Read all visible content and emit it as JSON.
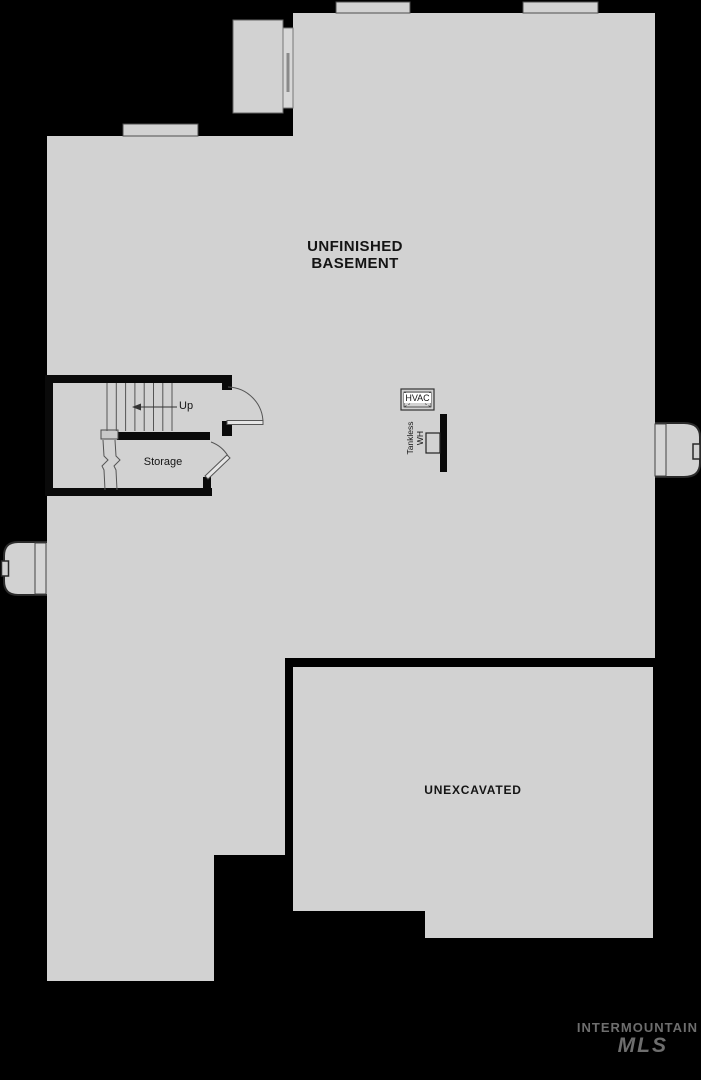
{
  "plan": {
    "rooms": {
      "main": {
        "label_line1": "UNFINISHED",
        "label_line2": "BASEMENT"
      },
      "unexcavated": {
        "label": "UNEXCAVATED"
      },
      "storage": {
        "label": "Storage"
      }
    },
    "stairs": {
      "direction_label": "Up"
    },
    "equipment": {
      "hvac_label": "HVAC",
      "water_heater_line1": "Tankless",
      "water_heater_line2": "WH"
    }
  },
  "watermark": {
    "line1": "INTERMOUNTAIN",
    "line2": "MLS"
  },
  "colors": {
    "background": "#000000",
    "floor": "#d2d2d2",
    "wall": "#0a0a0a",
    "line": "#4d4d4d",
    "watermark": "#6e6e6e"
  }
}
